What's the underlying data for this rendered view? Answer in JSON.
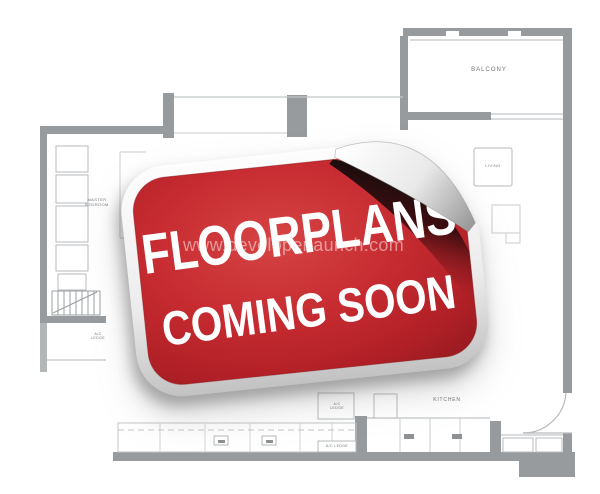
{
  "canvas": {
    "width": 600,
    "height": 494,
    "background": "#ffffff"
  },
  "sticker": {
    "line1": "FLOORPLANS",
    "line2": "COMING SOON",
    "colors": {
      "red": "#c5282e",
      "red_light": "#d64444",
      "red_dark": "#951a1f",
      "backing_light": "#fbfbfb",
      "backing_dark": "#c2c2c2",
      "curl_shadow": "#0d0d0d",
      "text": "#ffffff"
    }
  },
  "watermark": {
    "text": "www.developerlaunch.com",
    "color": "#ffffff",
    "opacity": 0.5
  },
  "floorplan": {
    "wall_color": "#979b9d",
    "thin_line_color": "#c2c6c8",
    "label_color": "#6f7477",
    "labels": {
      "balcony": "BALCONY",
      "living": "LIVING",
      "kitchen": "KITCHEN",
      "ac_ledge_top": "A/C LEDGE",
      "ac_ledge_bottom": "A/C LEDGE",
      "ac_ledge_left": "A/C LEDGE",
      "master_bedroom": "MASTER BEDROOM"
    }
  }
}
